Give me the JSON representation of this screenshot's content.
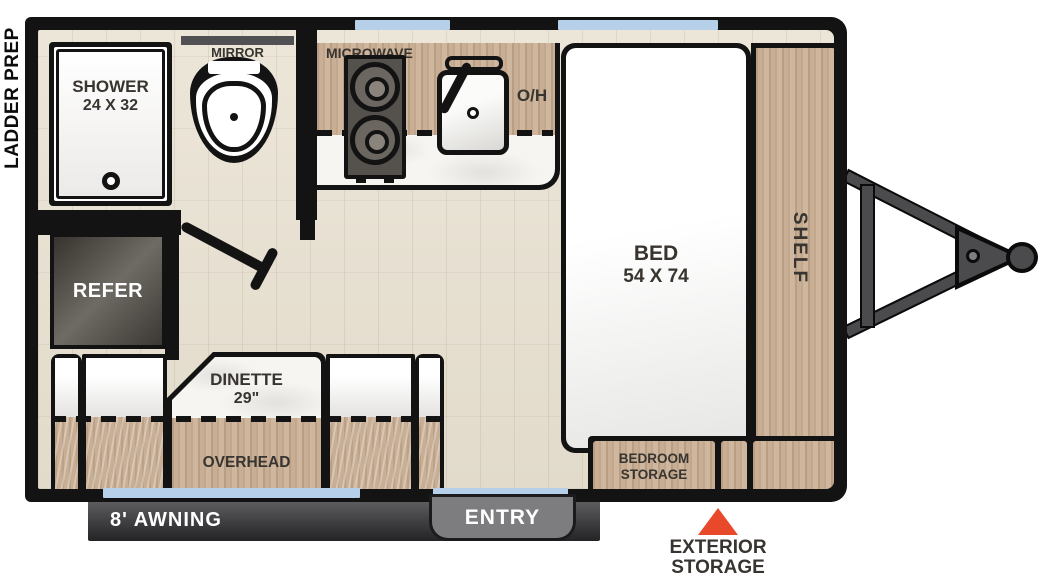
{
  "exterior": {
    "ladder_prep": "LADDER PREP",
    "awning": "8' AWNING",
    "entry": "ENTRY",
    "exterior_storage": {
      "line1": "EXTERIOR",
      "line2": "STORAGE"
    }
  },
  "bathroom": {
    "shower": "SHOWER",
    "shower_size": "24 X 32",
    "mirror": "MIRROR"
  },
  "kitchen": {
    "microwave": "MICROWAVE",
    "overhead_cabinet": "O/H"
  },
  "bedroom": {
    "bed": "BED",
    "bed_size": "54 X 74",
    "shelf": "SHELF",
    "storage": {
      "line1": "BEDROOM",
      "line2": "STORAGE"
    }
  },
  "living": {
    "refer": "REFER",
    "dinette": "DINETTE",
    "dinette_size": "29\"",
    "overhead": "OVERHEAD"
  },
  "icons": {
    "exterior_storage_marker": "triangle-up",
    "toilet": "toilet-top-view",
    "stove": "two-burner-cooktop",
    "sink": "sink-with-faucet",
    "hitch": "a-frame-tongue"
  },
  "colors": {
    "wall": "#131313",
    "window": "#b5d0e8",
    "wood": "#c8ae94",
    "floor": "#e9e2d4",
    "marble": "#f6f5f2",
    "accent": "#e8492b",
    "label": "#38342f",
    "steel": "#4b4b4d",
    "awning_dark": "#242426",
    "entry_gray": "#7d7d7f"
  }
}
